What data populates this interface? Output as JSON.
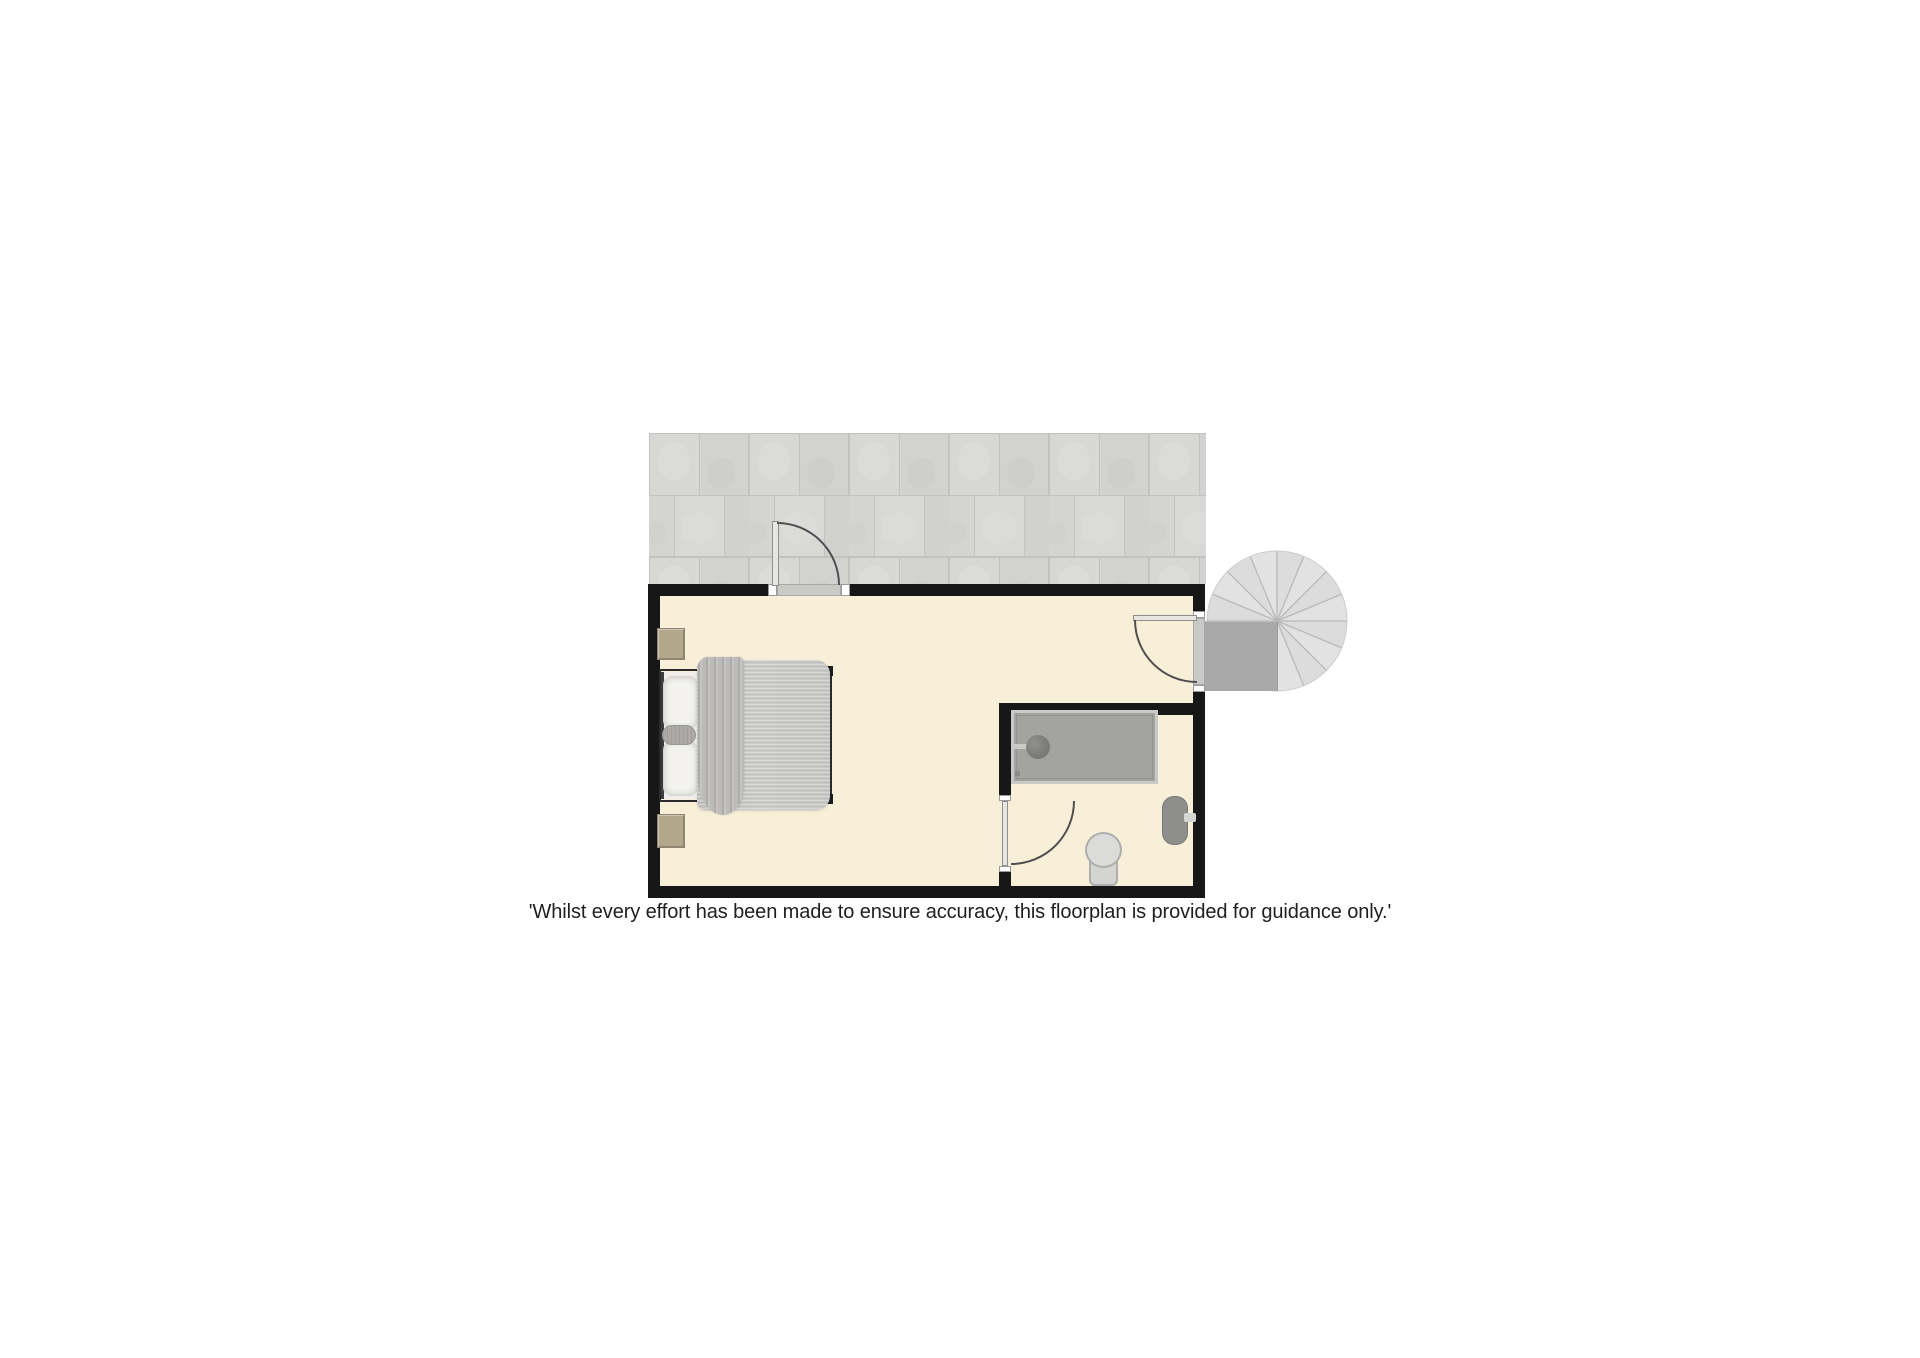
{
  "disclaimer": {
    "text": "'Whilst every effort has been made to ensure accuracy, this floorplan is provided for guidance only.'"
  },
  "floorplan": {
    "type": "floor-plan",
    "areas": [
      "terrace",
      "bedroom",
      "en-suite-shower-room"
    ],
    "features": [
      "double-bed",
      "nightstand-top",
      "nightstand-bottom",
      "pillows",
      "duvet",
      "throw-drape",
      "shower-tray",
      "shower-head",
      "toilet",
      "radiator",
      "terrace-door",
      "landing-door",
      "bathroom-door",
      "spiral-staircase",
      "stair-landing"
    ],
    "stairs": {
      "segments": 16
    },
    "colors": {
      "background": "#ffffff",
      "wall": "#171717",
      "floor": "#f8efd9",
      "tile": "#d4d4d2",
      "tile-grout": "#c2c2c0",
      "stair-fill": "#e2e2e2",
      "stair-line": "#b9b9b7",
      "landing": "#a9a9a9",
      "tray": "#a3a3a1",
      "tray-border": "#c9c9c7",
      "tray-drain": "#787876",
      "duvet": "#c7c7c5",
      "drape": "#bcbbb9",
      "pillow": "#f3f2f0",
      "bolster": "#acaba7",
      "nightstand": "#b2a68b",
      "nightstand-border": "#8d8472",
      "toilet": "#dbdbd9",
      "toilet-border": "#aeaeac",
      "radiator": "#8e8e8c",
      "door-leaf": "#e8e6e2",
      "door-arc": "#4f4f4f",
      "sill": "#ffffff",
      "threshold": "#c9c9c7",
      "text": "#1f1f1f"
    }
  }
}
